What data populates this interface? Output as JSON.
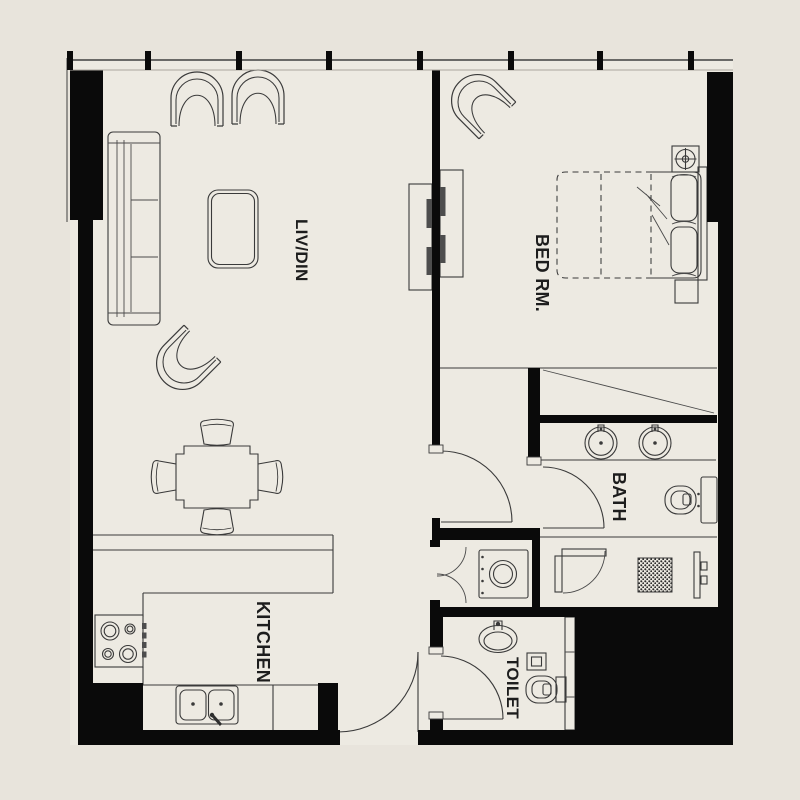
{
  "plan": {
    "type": "apartment-floor-plan",
    "rooms": [
      {
        "id": "living-dining",
        "label": "LIV/DIN"
      },
      {
        "id": "bedroom",
        "label": "BED RM."
      },
      {
        "id": "kitchen",
        "label": "KITCHEN"
      },
      {
        "id": "bath",
        "label": "BATH"
      },
      {
        "id": "toilet",
        "label": "TOILET"
      }
    ],
    "colors": {
      "background": "#e8e4dc",
      "floor": "#edeae2",
      "wall": "#0a0a0a",
      "line": "#3a3a3a",
      "text": "#1d1d1d"
    },
    "furniture_symbols": [
      "sofa",
      "armchair",
      "coffee-table",
      "dining-table",
      "dining-chair",
      "double-bed",
      "pillow",
      "nightstand",
      "sliding-wardrobe",
      "tv-cabinet",
      "dresser",
      "ceiling-fixture",
      "stove-hob",
      "kitchen-double-sink",
      "breakfast-counter",
      "washing-machine",
      "vanity-basin",
      "wall-hung-wc",
      "shower-enclosure",
      "floor-drain",
      "oval-wash-basin",
      "door-swing",
      "window-mullion"
    ]
  }
}
